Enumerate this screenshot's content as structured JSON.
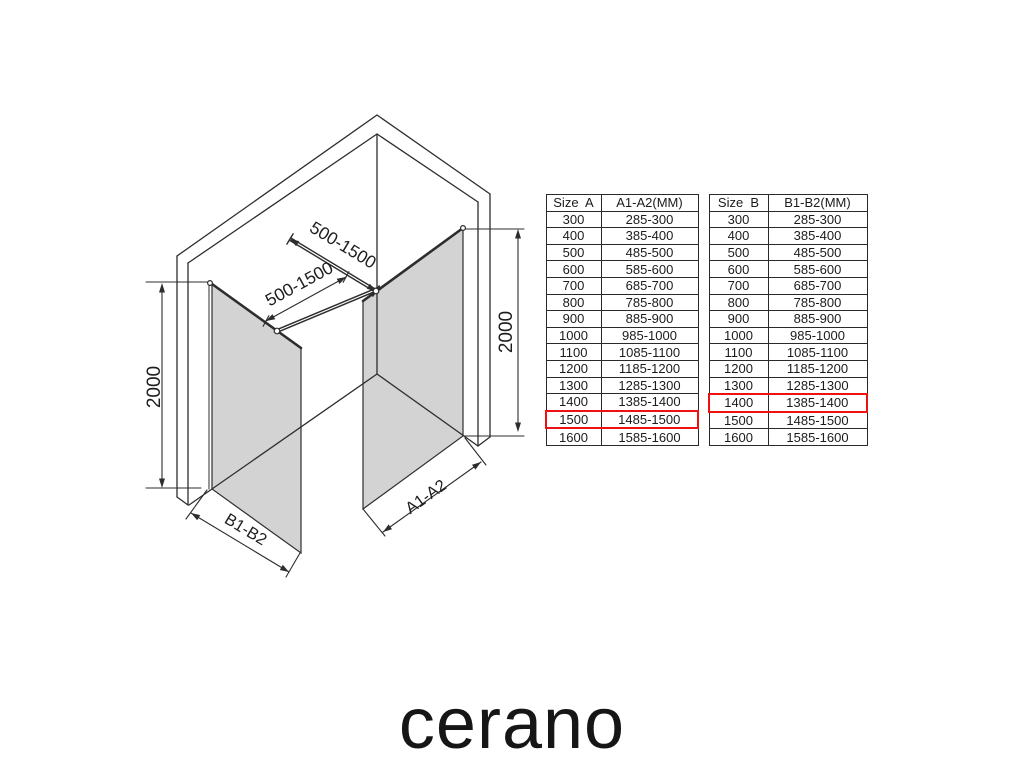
{
  "brand": {
    "logo_text": "cerano"
  },
  "diagram": {
    "labels": {
      "bar_top": "500-1500",
      "bar_bottom": "500-1500",
      "height_left": "2000",
      "height_right": "2000",
      "width_left": "B1-B2",
      "width_right": "A1-A2"
    },
    "colors": {
      "glass_fill": "#d3d3d3",
      "line": "#2d2d2d",
      "highlight_red": "#ee1111"
    }
  },
  "tables": [
    {
      "id": "a",
      "headers": [
        "Size  A",
        "A1-A2(MM)"
      ],
      "highlight_size": "1500",
      "rows": [
        [
          "300",
          "285-300"
        ],
        [
          "400",
          "385-400"
        ],
        [
          "500",
          "485-500"
        ],
        [
          "600",
          "585-600"
        ],
        [
          "700",
          "685-700"
        ],
        [
          "800",
          "785-800"
        ],
        [
          "900",
          "885-900"
        ],
        [
          "1000",
          "985-1000"
        ],
        [
          "1100",
          "1085-1100"
        ],
        [
          "1200",
          "1185-1200"
        ],
        [
          "1300",
          "1285-1300"
        ],
        [
          "1400",
          "1385-1400"
        ],
        [
          "1500",
          "1485-1500"
        ],
        [
          "1600",
          "1585-1600"
        ]
      ]
    },
    {
      "id": "b",
      "headers": [
        "Size  B",
        "B1-B2(MM)"
      ],
      "highlight_size": "1400",
      "rows": [
        [
          "300",
          "285-300"
        ],
        [
          "400",
          "385-400"
        ],
        [
          "500",
          "485-500"
        ],
        [
          "600",
          "585-600"
        ],
        [
          "700",
          "685-700"
        ],
        [
          "800",
          "785-800"
        ],
        [
          "900",
          "885-900"
        ],
        [
          "1000",
          "985-1000"
        ],
        [
          "1100",
          "1085-1100"
        ],
        [
          "1200",
          "1185-1200"
        ],
        [
          "1300",
          "1285-1300"
        ],
        [
          "1400",
          "1385-1400"
        ],
        [
          "1500",
          "1485-1500"
        ],
        [
          "1600",
          "1585-1600"
        ]
      ]
    }
  ]
}
